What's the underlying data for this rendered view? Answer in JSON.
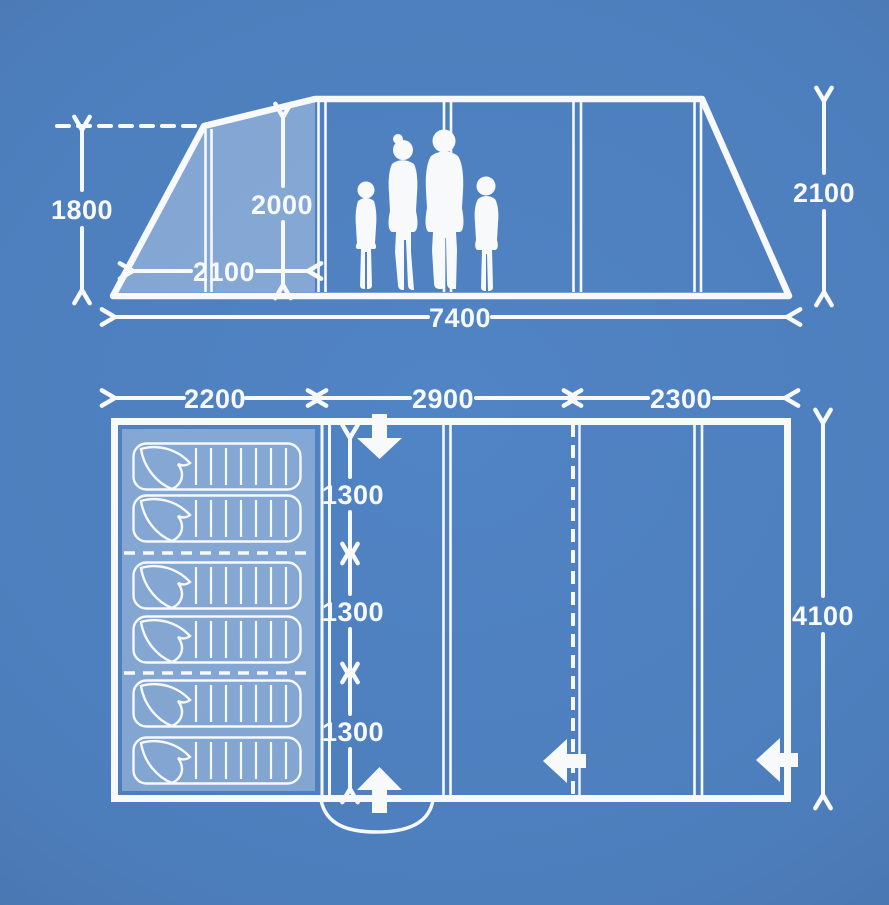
{
  "meta": {
    "colors": {
      "background": "#4d7ebc",
      "line": "#f7f9fb",
      "shaded_panel": "rgba(255,255,255,0.30)"
    },
    "icons": {
      "dimension_arrow": "chevron-line-arrow",
      "door_arrow": "solid-block-arrow",
      "sleeping_bag": "outlined-sleeping-bag",
      "family": "family-silhouette"
    }
  },
  "side_view": {
    "labels": {
      "peak_height": "1800",
      "standing_height": "2000",
      "porch_depth": "2100",
      "total_length": "7400",
      "rear_height": "2100"
    }
  },
  "floor_plan": {
    "berth_count": 6,
    "labels": {
      "section_1_width": "2200",
      "section_2_width": "2900",
      "section_3_width": "2300",
      "berth_1_depth": "1300",
      "berth_2_depth": "1300",
      "berth_3_depth": "1300",
      "total_depth": "4100"
    }
  }
}
